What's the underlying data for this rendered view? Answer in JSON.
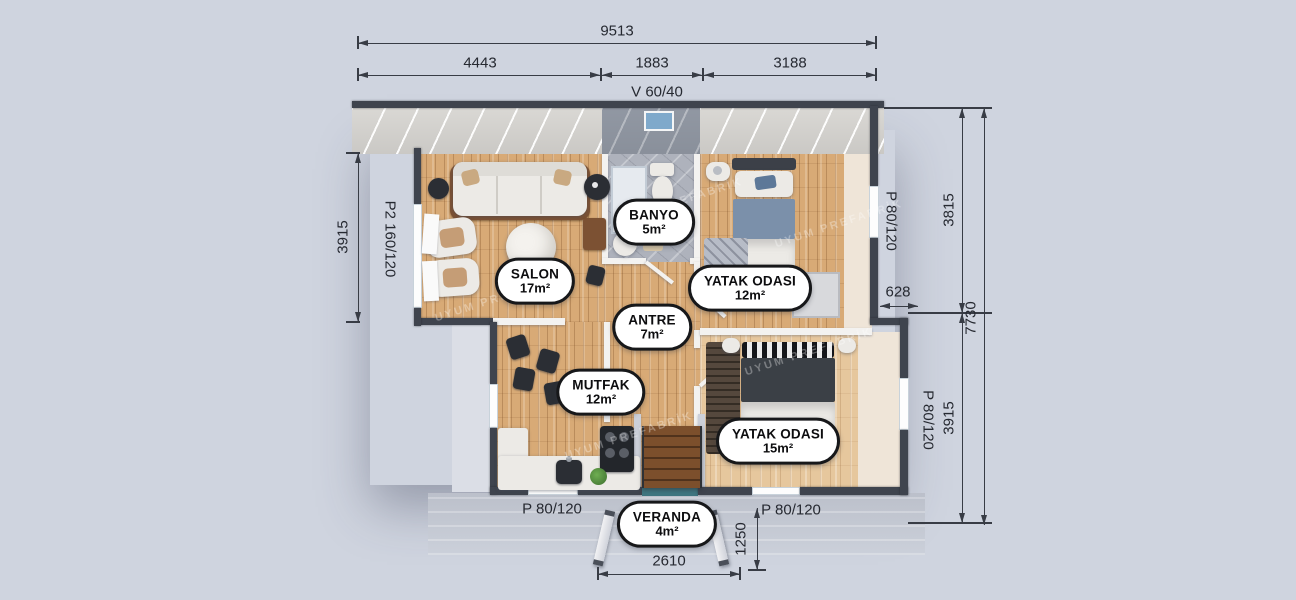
{
  "watermark": "UYUM PREFABRİK",
  "colors": {
    "background": "#cfd4df",
    "wall": "#3f444e",
    "wood_floor": "#d8aa76",
    "bath_floor": "#aeb2bc",
    "roof_gray": "#99a0ac",
    "veranda_deck": "#c7ccd7",
    "badge_border": "#17181a",
    "dimension_text": "#262931",
    "skylight_glass": "#7fa9cb",
    "entry_threshold": "#3f7680"
  },
  "dimensions": {
    "top": {
      "overall": "9513",
      "seg1": "4443",
      "seg2": "1883",
      "seg3": "3188",
      "vent": "V 60/40"
    },
    "left": {
      "height": "3915",
      "window": "P2 160/120"
    },
    "right": {
      "window_upper": "P 80/120",
      "height_upper": "3815",
      "offset": "628",
      "total": "7730",
      "window_lower": "P 80/120",
      "height_lower": "3915"
    },
    "bottom": {
      "window_left": "P 80/120",
      "window_right": "P 80/120",
      "depth": "1250",
      "width": "2610"
    }
  },
  "rooms": [
    {
      "name": "SALON",
      "area": "17m²"
    },
    {
      "name": "BANYO",
      "area": "5m²"
    },
    {
      "name": "YATAK ODASI",
      "area": "12m²"
    },
    {
      "name": "ANTRE",
      "area": "7m²"
    },
    {
      "name": "MUTFAK",
      "area": "12m²"
    },
    {
      "name": "YATAK ODASI",
      "area": "15m²"
    },
    {
      "name": "VERANDA",
      "area": "4m²"
    }
  ]
}
